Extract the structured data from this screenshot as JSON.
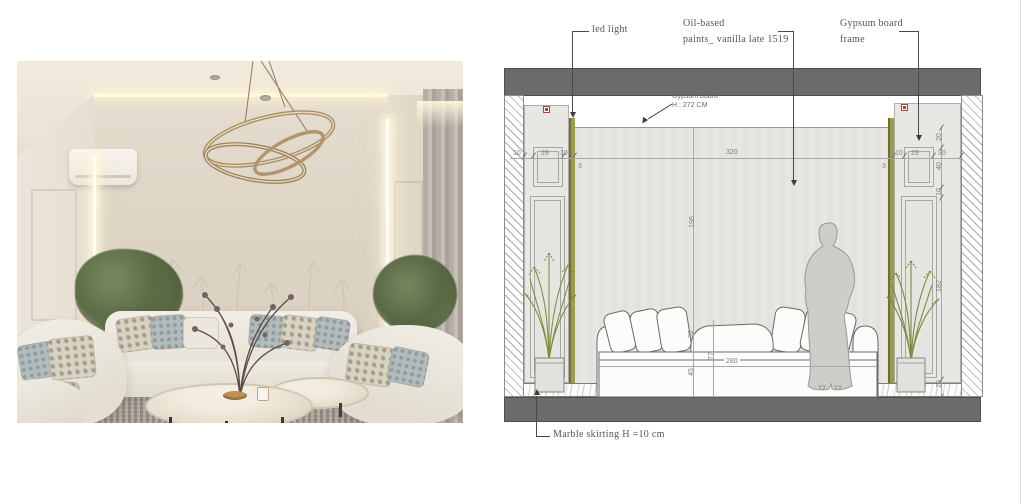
{
  "colors": {
    "band_gray": "#6b6b6b",
    "wall_gray": "#e4e3e0",
    "led_olive": "#8f9140",
    "plant_green": "#7d8c3f",
    "detail_tag_red": "#c0392b",
    "photo_wall_beige": "#ddd4c6"
  },
  "drawing": {
    "callouts": {
      "led_light": "led light",
      "oil_paint_1": "Oil-based",
      "oil_paint_2": "paints_ vanilla late 1519",
      "gypsum_frame_1": "Gypsum board",
      "gypsum_frame_2": "frame"
    },
    "notes": {
      "gypsum_board_1": "Gypsum board",
      "gypsum_board_2": "H : 272 CM",
      "marble_skirting": "Marble skirting H =10 cm"
    },
    "dims": {
      "wall_width": "320",
      "wall_height": "196",
      "sofa_length": "280",
      "sofa_back": "77",
      "cushion": "32",
      "seat": "45",
      "left_chain": [
        "10",
        "29",
        "10"
      ],
      "left_led": "3",
      "right_chain": [
        "10",
        "29",
        "30"
      ],
      "right_led": "3",
      "right_vert": [
        "20",
        "40",
        "10",
        "182",
        "20"
      ]
    }
  }
}
